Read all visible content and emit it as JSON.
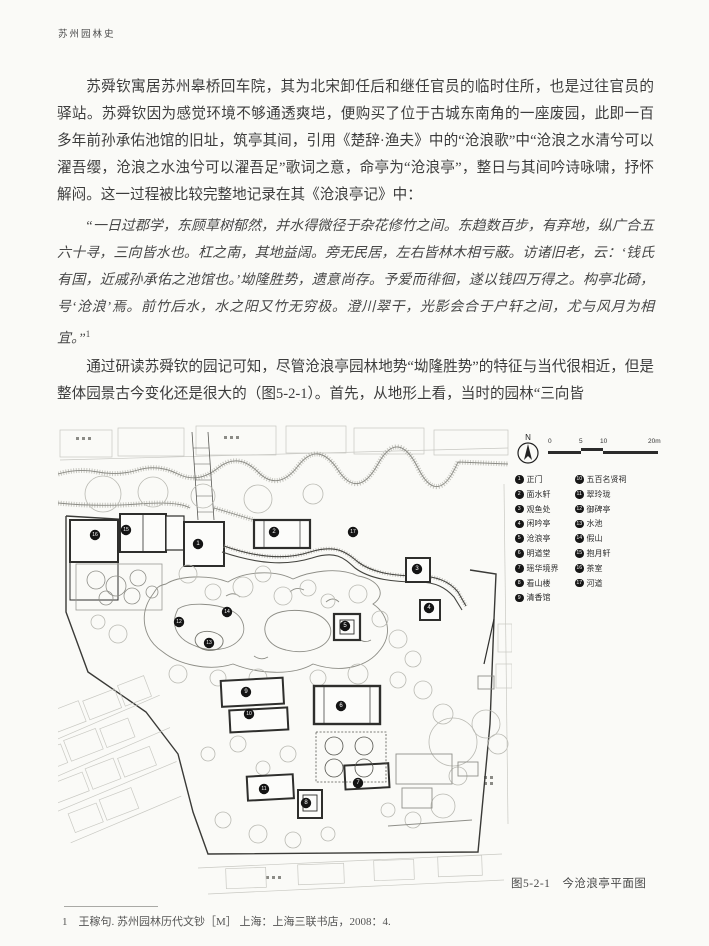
{
  "page": {
    "running_header": "苏州园林史",
    "para1": "苏舜钦寓居苏州皋桥回车院，其为北宋卸任后和继任官员的临时住所，也是过往官员的驿站。苏舜钦因为感觉环境不够通透爽垲，便购买了位于古城东南角的一座废园，此即一百多年前孙承佑池馆的旧址，筑亭其间，引用《楚辞·渔夫》中的“沧浪歌”中“沧浪之水清兮可以濯吾缨，沧浪之水浊兮可以濯吾足”歌词之意，命亭为“沧浪亭”，整日与其间吟诗咏啸，抒怀解闷。这一过程被比较完整地记录在其《沧浪亭记》中：",
    "quote": "“一日过郡学，东顾草树郁然，并水得微径于杂花修竹之间。东趋数百步，有弃地，纵广合五六十寻，三向皆水也。杠之南，其地益阔。旁无民居，左右皆林木相亏蔽。访诸旧老，云：‘钱氏有国，近戚孙承佑之池馆也。’坳隆胜势，遗意尚存。予爱而徘徊，遂以钱四万得之。构亭北碕，号‘沧浪’焉。前竹后水，水之阳又竹无穷极。澄川翠干，光影会合于户轩之间，尤与风月为相宜。”",
    "quote_ref": "1",
    "para2": "通过研读苏舜钦的园记可知，尽管沧浪亭园林地势“坳隆胜势”的特征与当代很相近，但是整体园景古今变化还是很大的（图5-2-1）。首先，从地形上看，当时的园林“三向皆",
    "footnote": "1　王稼句. 苏州园林历代文钞［M］ 上海：上海三联书店，2008：4."
  },
  "figure": {
    "caption": "图5-2-1　今沧浪亭平面图",
    "compass_label": "N",
    "scale": {
      "ticks": [
        "0",
        "5",
        "10",
        "20m"
      ]
    },
    "legend": [
      {
        "num": "1",
        "label": "正门"
      },
      {
        "num": "2",
        "label": "面水轩"
      },
      {
        "num": "3",
        "label": "观鱼处"
      },
      {
        "num": "4",
        "label": "闲吟亭"
      },
      {
        "num": "5",
        "label": "沧浪亭"
      },
      {
        "num": "6",
        "label": "明道堂"
      },
      {
        "num": "7",
        "label": "瑶华境界"
      },
      {
        "num": "8",
        "label": "看山楼"
      },
      {
        "num": "9",
        "label": "清香馆"
      },
      {
        "num": "10",
        "label": "五百名贤祠"
      },
      {
        "num": "11",
        "label": "翠玲珑"
      },
      {
        "num": "12",
        "label": "御碑亭"
      },
      {
        "num": "13",
        "label": "水池"
      },
      {
        "num": "14",
        "label": "假山"
      },
      {
        "num": "15",
        "label": "抱月轩"
      },
      {
        "num": "16",
        "label": "茶室"
      },
      {
        "num": "17",
        "label": "河道"
      }
    ],
    "map_markers": [
      {
        "n": "1",
        "x": 140,
        "y": 120
      },
      {
        "n": "2",
        "x": 216,
        "y": 108
      },
      {
        "n": "3",
        "x": 359,
        "y": 145
      },
      {
        "n": "4",
        "x": 371,
        "y": 184
      },
      {
        "n": "5",
        "x": 287,
        "y": 202
      },
      {
        "n": "6",
        "x": 283,
        "y": 282
      },
      {
        "n": "7",
        "x": 300,
        "y": 359
      },
      {
        "n": "8",
        "x": 248,
        "y": 379
      },
      {
        "n": "9",
        "x": 188,
        "y": 268
      },
      {
        "n": "10",
        "x": 191,
        "y": 290
      },
      {
        "n": "11",
        "x": 206,
        "y": 365
      },
      {
        "n": "12",
        "x": 121,
        "y": 198
      },
      {
        "n": "13",
        "x": 151,
        "y": 219
      },
      {
        "n": "14",
        "x": 169,
        "y": 188
      },
      {
        "n": "15",
        "x": 68,
        "y": 106
      },
      {
        "n": "16",
        "x": 37,
        "y": 111
      },
      {
        "n": "17",
        "x": 295,
        "y": 108
      }
    ]
  }
}
